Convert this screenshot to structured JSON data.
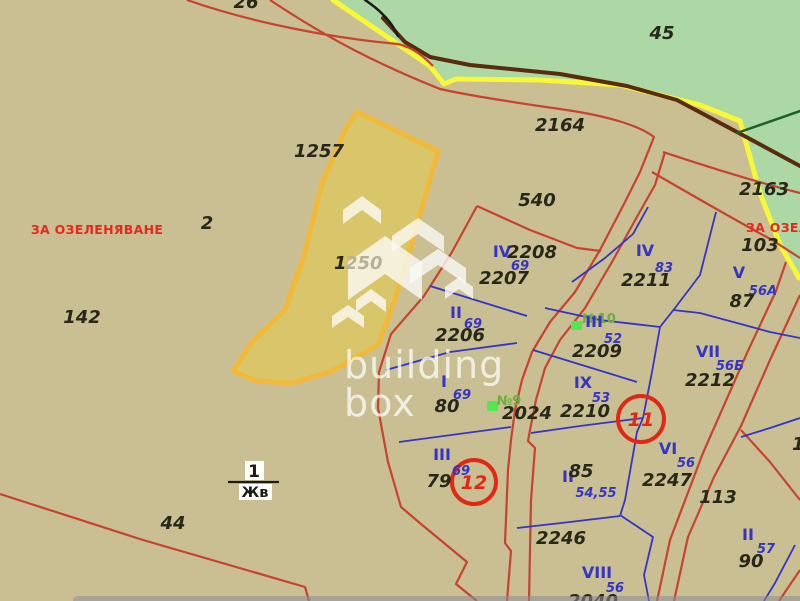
{
  "map": {
    "title": "cadastral-map",
    "colors": {
      "bg": "#c9bf92",
      "greenery": "#abd8a4",
      "road_yellow": "#f9f838",
      "road_brown": "#5a2b0e",
      "dark_green_line": "#1d5e2b",
      "black_line": "#1a1a1a",
      "red_line": "#c8432f",
      "red_circle": "#e02815",
      "blue_line": "#3434c6",
      "dark_text": "#28281a",
      "orange_border": "#f2b838",
      "orange_fill": "#d9c66b",
      "green_marker": "#52e852",
      "white": "#ffffff"
    },
    "areas": {
      "greenery": "M333,0 L433,66 L446,85 L457,79 L540,80 L620,85 L700,105 L742,121 L762,194 L783,248 L795,270 L800,277 L800,0 Z"
    },
    "selected_parcel": {
      "label": "1250",
      "points": "357,112 438,151 415,232 395,300 378,345 330,372 292,383 256,381 233,371 252,342 285,310 305,252 322,183 345,130"
    },
    "base_lines": [
      {
        "name": "road-yellow-line",
        "color": "road_yellow",
        "w": 5,
        "d": "M333,0 L430,66 L444,84 L456,79 L540,80 L620,85 L700,105 L740,121 L760,193 L781,247 L794,269 L799,278"
      },
      {
        "name": "road-brown-line",
        "color": "road_brown",
        "w": 4,
        "d": "M383,18 L405,42 L430,57 L470,65 L560,74 L627,86 L677,100 L737,132 L800,166"
      },
      {
        "name": "dark-green-boundary",
        "color": "dark_green_line",
        "w": 2.5,
        "d": "M737,133 L800,111"
      },
      {
        "name": "black-contour",
        "color": "black_line",
        "w": 2.5,
        "d": "M365,0 C380,10 392,22 398,36"
      }
    ],
    "red_lines": [
      {
        "name": "red-boundary-top-1",
        "d": "M187,0 C250,22 330,38 398,44 C415,48 425,58 433,66"
      },
      {
        "name": "red-boundary-top-2-road-west",
        "d": "M270,0 C330,40 380,65 440,89 C480,98 540,106 573,111 C610,117 640,126 654,137 L640,172 L625,202 L600,250 L575,292 L550,322 L532,352 L522,380 L515,410 L511,440 L508,470 L505,543 L511,551 L507,601"
      },
      {
        "name": "red-road-east-edge",
        "d": "M665,152 L655,185 L638,215 L612,262 L585,308 L560,340 L545,368 L536,400 L531,425 L528,441 L535,448 L531,500 L529,601"
      },
      {
        "name": "red-road-2163-north",
        "d": "M663,152 C700,164 745,179 800,193"
      },
      {
        "name": "red-road-2163-south",
        "d": "M652,172 C690,194 735,220 772,240 L800,258"
      },
      {
        "name": "red-road-southeast-1",
        "d": "M786,262 L776,291 L747,353 L703,453 L670,540 L657,601"
      },
      {
        "name": "red-road-southeast-2",
        "d": "M800,295 L770,360 L741,426 L714,477 L688,537 L674,601"
      },
      {
        "name": "red-road-branch-se",
        "d": "M741,430 L770,462 L800,500"
      },
      {
        "name": "red-corner-se",
        "d": "M800,570 L779,601"
      },
      {
        "name": "red-boundary-bottom-west",
        "d": "M0,494 L143,540 L305,587 L309,601"
      },
      {
        "name": "red-block-west-boundary",
        "d": "M477,206 L452,252 L424,296 L391,334 L379,372 L378,408 L388,462 L401,507 L421,524 L467,562 L456,584 L477,601"
      },
      {
        "name": "red-block-north-boundary",
        "d": "M477,206 L530,230 L577,248 L601,251"
      }
    ],
    "blue_lines": [
      {
        "name": "blue-parcel-edge-2207-2206",
        "d": "M430,286 L527,316"
      },
      {
        "name": "blue-parcel-edge-2206-80",
        "d": "M386,370 L450,352 L517,343"
      },
      {
        "name": "blue-parcel-edge-80-79",
        "d": "M399,442 L511,427"
      },
      {
        "name": "blue-parcel-edge-2211-west",
        "d": "M572,282 L605,258 L633,234 L648,207"
      },
      {
        "name": "blue-parcel-edge-2211-east",
        "d": "M716,212 L700,275 L675,308 L660,327"
      },
      {
        "name": "blue-parcel-edge-2209-north",
        "d": "M545,308 L600,320 L660,327"
      },
      {
        "name": "blue-parcel-edge-2209-south",
        "d": "M533,350 L585,366 L637,382"
      },
      {
        "name": "blue-parcel-edge-2210-south",
        "d": "M531,433 L580,426 L643,418"
      },
      {
        "name": "blue-parcel-edge-center",
        "d": "M660,327 L652,372 L643,418"
      },
      {
        "name": "blue-parcel-edge-87-2212",
        "d": "M673,310 L700,313 L770,332 L800,338"
      },
      {
        "name": "blue-parcel-edge-85-2247",
        "d": "M643,418 L637,432 L625,500 L620,516"
      },
      {
        "name": "blue-parcel-edge-2246-north",
        "d": "M517,528 L570,522 L620,516"
      },
      {
        "name": "blue-parcel-edge-2246-east",
        "d": "M620,515 L653,537 L644,575 L649,601"
      },
      {
        "name": "blue-parcel-edge-90-north",
        "d": "M800,418 L770,428 L741,437"
      },
      {
        "name": "blue-parcel-edge-90-south",
        "d": "M795,545 L775,583 L764,601"
      }
    ],
    "circles": [
      {
        "name": "annotation-circle-11",
        "x": 641,
        "y": 419,
        "r": 23
      },
      {
        "name": "annotation-circle-12",
        "x": 474,
        "y": 482,
        "r": 22
      }
    ],
    "markers": [
      {
        "name": "building-marker-9",
        "x": 487,
        "y": 401,
        "w": 11,
        "h": 10
      },
      {
        "name": "building-marker-10",
        "x": 571,
        "y": 321,
        "w": 11,
        "h": 9
      }
    ],
    "watermark": {
      "line1": "building",
      "line2": "box",
      "shapes": [
        "343,210 362,196 381,210 381,224 362,210 343,224",
        "392,236 418,218 444,236 444,252 418,234 392,252",
        "348,262 385,236 422,262 422,300 385,274 348,300",
        "410,268 438,249 466,268 466,284 438,265 410,284",
        "356,300 371,289 386,300 386,312 371,301 356,312",
        "445,287 459,277 473,287 473,299 459,289 445,299",
        "332,316 348,305 364,316 364,328 348,317 332,328"
      ]
    },
    "fraction": {
      "top": "1",
      "bottom": "Жв"
    },
    "labels": [
      {
        "t": "ЗА ОЗЕЛЕНЯВАНЕ",
        "x": 97,
        "y": 234,
        "c": "zone"
      },
      {
        "t": "ЗА ОЗЕЛЕНЯВАНЕ",
        "x": 746,
        "y": 232,
        "c": "zone",
        "a": "start"
      },
      {
        "t": "26",
        "x": 246,
        "y": 8,
        "c": "num"
      },
      {
        "t": "45",
        "x": 662,
        "y": 39,
        "c": "num"
      },
      {
        "t": "2164",
        "x": 560,
        "y": 131,
        "c": "num"
      },
      {
        "t": "1257",
        "x": 319,
        "y": 157,
        "c": "num"
      },
      {
        "t": "2163",
        "x": 764,
        "y": 195,
        "c": "num"
      },
      {
        "t": "540",
        "x": 537,
        "y": 206,
        "c": "num"
      },
      {
        "t": "103",
        "x": 760,
        "y": 251,
        "c": "num"
      },
      {
        "t": "2",
        "x": 207,
        "y": 229,
        "c": "num"
      },
      {
        "t": "142",
        "x": 82,
        "y": 323,
        "c": "num"
      },
      {
        "t": "1",
        "x": 334,
        "y": 269,
        "c": "num",
        "a": "start"
      },
      {
        "t": "250",
        "x": 345,
        "y": 269,
        "c": "numf",
        "a": "start"
      },
      {
        "t": "IV",
        "x": 502,
        "y": 257,
        "c": "roman"
      },
      {
        "t": "2208",
        "x": 532,
        "y": 258,
        "c": "num"
      },
      {
        "t": "69",
        "x": 520,
        "y": 270,
        "c": "bnum"
      },
      {
        "t": "2207",
        "x": 504,
        "y": 284,
        "c": "num"
      },
      {
        "t": "II",
        "x": 456,
        "y": 318,
        "c": "roman"
      },
      {
        "t": "69",
        "x": 473,
        "y": 328,
        "c": "bnum"
      },
      {
        "t": "2206",
        "x": 460,
        "y": 341,
        "c": "num"
      },
      {
        "t": "IV",
        "x": 645,
        "y": 256,
        "c": "roman"
      },
      {
        "t": "83",
        "x": 664,
        "y": 272,
        "c": "bnum"
      },
      {
        "t": "2211",
        "x": 646,
        "y": 286,
        "c": "num"
      },
      {
        "t": "V",
        "x": 739,
        "y": 278,
        "c": "roman"
      },
      {
        "t": "56А",
        "x": 763,
        "y": 295,
        "c": "bnum"
      },
      {
        "t": "87",
        "x": 742,
        "y": 307,
        "c": "num"
      },
      {
        "t": "№10",
        "x": 599,
        "y": 323,
        "c": "gnum"
      },
      {
        "t": "III",
        "x": 594,
        "y": 327,
        "c": "roman"
      },
      {
        "t": "52",
        "x": 613,
        "y": 343,
        "c": "bnum"
      },
      {
        "t": "2209",
        "x": 597,
        "y": 357,
        "c": "num"
      },
      {
        "t": "VII",
        "x": 708,
        "y": 357,
        "c": "roman"
      },
      {
        "t": "56Б",
        "x": 730,
        "y": 370,
        "c": "bnum"
      },
      {
        "t": "2212",
        "x": 710,
        "y": 386,
        "c": "num"
      },
      {
        "t": "IX",
        "x": 583,
        "y": 388,
        "c": "roman"
      },
      {
        "t": "53",
        "x": 601,
        "y": 402,
        "c": "bnum"
      },
      {
        "t": "2210",
        "x": 585,
        "y": 417,
        "c": "num"
      },
      {
        "t": "I",
        "x": 444,
        "y": 387,
        "c": "roman"
      },
      {
        "t": "69",
        "x": 462,
        "y": 399,
        "c": "bnum"
      },
      {
        "t": "80",
        "x": 447,
        "y": 412,
        "c": "num"
      },
      {
        "t": "№9",
        "x": 509,
        "y": 405,
        "c": "gnum"
      },
      {
        "t": "2024",
        "x": 527,
        "y": 419,
        "c": "num"
      },
      {
        "t": "11",
        "x": 641,
        "y": 426,
        "c": "rnum"
      },
      {
        "t": "VI",
        "x": 668,
        "y": 454,
        "c": "roman"
      },
      {
        "t": "56",
        "x": 686,
        "y": 467,
        "c": "bnum"
      },
      {
        "t": "2247",
        "x": 667,
        "y": 486,
        "c": "num"
      },
      {
        "t": "III",
        "x": 442,
        "y": 460,
        "c": "roman"
      },
      {
        "t": "69",
        "x": 461,
        "y": 475,
        "c": "bnum"
      },
      {
        "t": "79",
        "x": 439,
        "y": 487,
        "c": "num"
      },
      {
        "t": "12",
        "x": 474,
        "y": 489,
        "c": "rnum"
      },
      {
        "t": "II",
        "x": 568,
        "y": 482,
        "c": "roman"
      },
      {
        "t": "85",
        "x": 581,
        "y": 477,
        "c": "num"
      },
      {
        "t": "54,55",
        "x": 596,
        "y": 497,
        "c": "bnum"
      },
      {
        "t": "113",
        "x": 718,
        "y": 503,
        "c": "num"
      },
      {
        "t": "16",
        "x": 792,
        "y": 450,
        "c": "num",
        "a": "start"
      },
      {
        "t": "2246",
        "x": 561,
        "y": 544,
        "c": "num"
      },
      {
        "t": "II",
        "x": 748,
        "y": 540,
        "c": "roman"
      },
      {
        "t": "57",
        "x": 766,
        "y": 553,
        "c": "bnum"
      },
      {
        "t": "90",
        "x": 751,
        "y": 567,
        "c": "num"
      },
      {
        "t": "44",
        "x": 173,
        "y": 529,
        "c": "num"
      },
      {
        "t": "VIII",
        "x": 597,
        "y": 578,
        "c": "roman"
      },
      {
        "t": "56",
        "x": 615,
        "y": 592,
        "c": "bnum"
      },
      {
        "t": "2040",
        "x": 593,
        "y": 607,
        "c": "num"
      }
    ]
  }
}
